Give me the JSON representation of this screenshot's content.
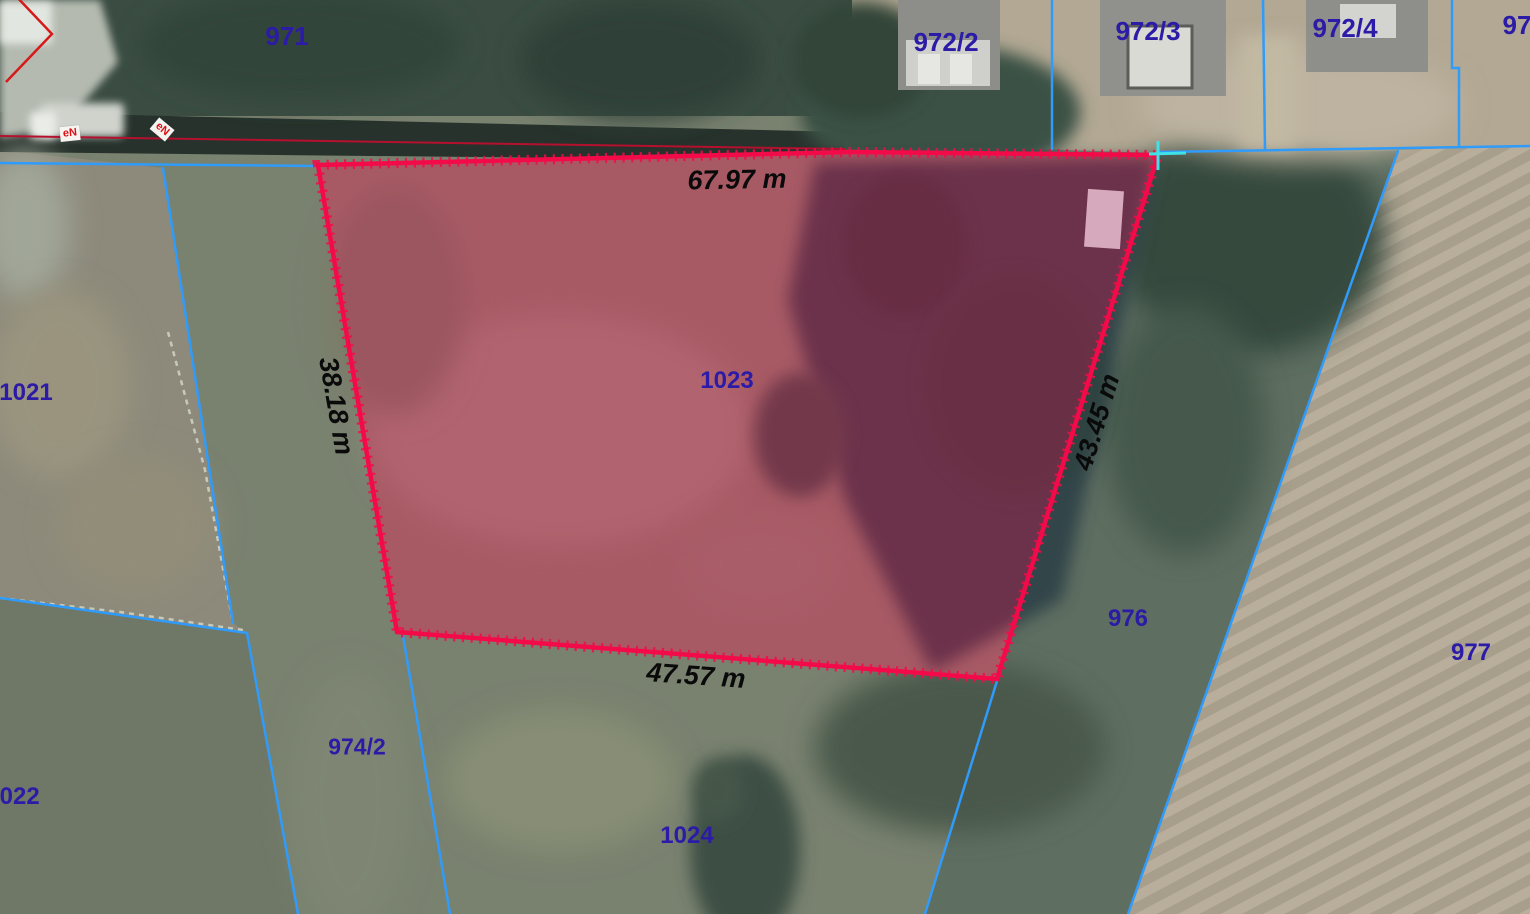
{
  "map": {
    "highlighted": {
      "parcel_id": "1023",
      "side_top": "67.97 m",
      "side_left": "38.18 m",
      "side_right": "43.45 m",
      "side_bottom": "47.57 m"
    },
    "parcels": {
      "p971": "971",
      "p972_2": "972/2",
      "p972_3": "972/3",
      "p972_4": "972/4",
      "p97x": "97",
      "p1021": "1021",
      "p1022": "1022",
      "p974_2": "974/2",
      "p1023": "1023",
      "p1024": "1024",
      "p976": "976",
      "p977": "977"
    },
    "utility_markers": {
      "m1": "eN",
      "m2": "eN"
    },
    "colors": {
      "highlight_boundary": "#f30b49",
      "highlight_fill": "rgba(221,16,80,0.34)",
      "cadastral_line": "#2f9bfa",
      "parcel_label": "#2b1ba6",
      "dimension_text": "#0a0a0a",
      "corner_marker": "#3fe2e8",
      "utility_marker_red": "#dc1016"
    }
  }
}
